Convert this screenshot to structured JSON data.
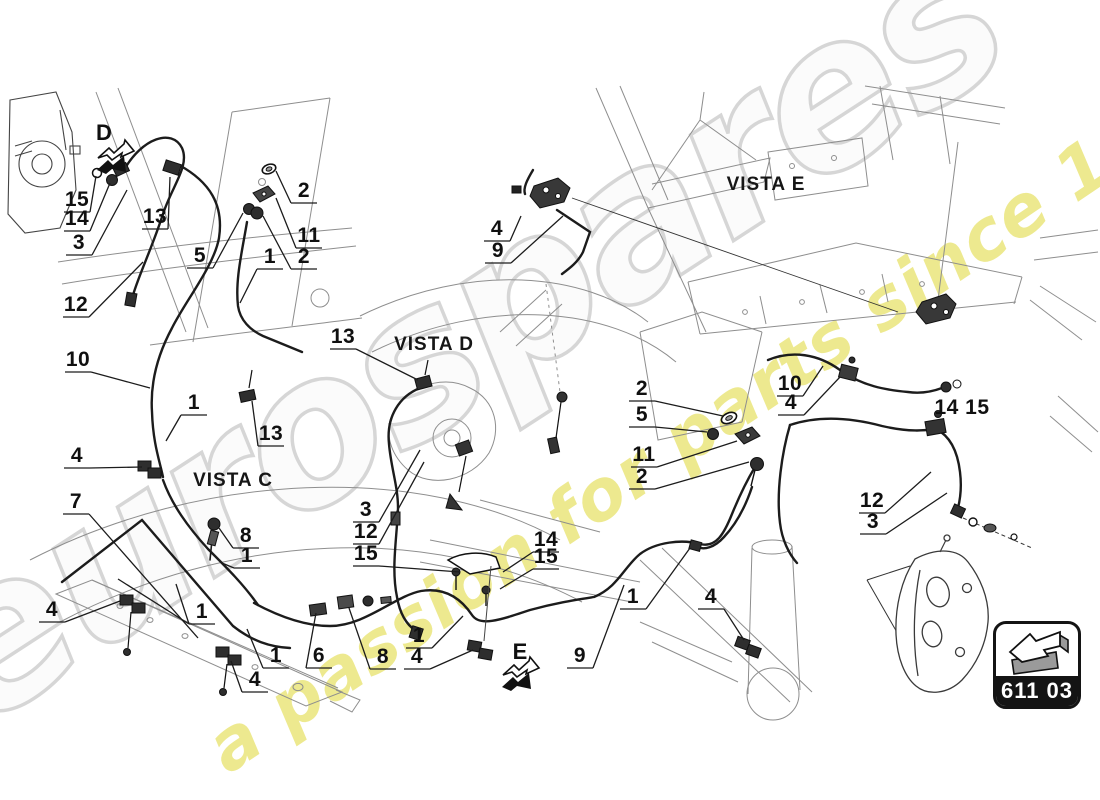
{
  "page": {
    "background": "#ffffff",
    "line_color": "#1c1c1c",
    "chassis_line_color": "#8e8e8e"
  },
  "watermark": {
    "brand": "eurospares",
    "tagline": "a passion for parts since 1985",
    "brand_fill": "#fbfbfb",
    "brand_outline": "#d4d4d4",
    "tagline_color": "#e9e474"
  },
  "badge": {
    "code": "611 03",
    "icon": "3d-arrow-left-icon"
  },
  "views": [
    "VISTA C",
    "VISTA D",
    "VISTA E"
  ],
  "direction_markers": [
    "D",
    "E"
  ],
  "callouts": [
    {
      "t": "15",
      "x": 77,
      "y": 200,
      "tx": 96,
      "ty": 176
    },
    {
      "t": "14",
      "x": 77,
      "y": 219,
      "tx": 110,
      "ty": 183
    },
    {
      "t": "3",
      "x": 79,
      "y": 243,
      "tx": 127,
      "ty": 190
    },
    {
      "t": "13",
      "x": 155,
      "y": 217,
      "tx": 170,
      "ty": 177
    },
    {
      "t": "12",
      "x": 76,
      "y": 305,
      "tx": 143,
      "ty": 262
    },
    {
      "t": "5",
      "x": 200,
      "y": 256,
      "tx": 243,
      "ty": 213
    },
    {
      "t": "1",
      "x": 270,
      "y": 257,
      "tx": 240,
      "ty": 303
    },
    {
      "t": "2",
      "x": 304,
      "y": 191,
      "tx": 276,
      "ty": 171
    },
    {
      "t": "11",
      "x": 309,
      "y": 236,
      "tx": 276,
      "ty": 198
    },
    {
      "t": "2",
      "x": 304,
      "y": 257,
      "tx": 263,
      "ty": 216
    },
    {
      "t": "10",
      "x": 78,
      "y": 360,
      "tx": 150,
      "ty": 388
    },
    {
      "t": "1",
      "x": 194,
      "y": 403,
      "tx": 166,
      "ty": 441
    },
    {
      "t": "13",
      "x": 271,
      "y": 434,
      "tx": 252,
      "ty": 401
    },
    {
      "t": "4",
      "x": 77,
      "y": 456,
      "tx": 142,
      "ty": 467
    },
    {
      "t": "7",
      "x": 76,
      "y": 502,
      "tx": 198,
      "ty": 638
    },
    {
      "t": "8",
      "x": 246,
      "y": 536,
      "tx": 219,
      "ty": 528
    },
    {
      "t": "1",
      "x": 247,
      "y": 556,
      "tx": 222,
      "ty": 563
    },
    {
      "t": "4",
      "x": 52,
      "y": 610,
      "tx": 120,
      "ty": 601
    },
    {
      "t": "1",
      "x": 202,
      "y": 612,
      "tx": 118,
      "ty": 579,
      "tx2": 176,
      "ty2": 584
    },
    {
      "t": "1",
      "x": 276,
      "y": 656,
      "tx": 247,
      "ty": 629
    },
    {
      "t": "6",
      "x": 319,
      "y": 656,
      "tx": 316,
      "ty": 613
    },
    {
      "t": "4",
      "x": 255,
      "y": 680,
      "tx": 231,
      "ty": 661
    },
    {
      "t": "8",
      "x": 383,
      "y": 657,
      "tx": 349,
      "ty": 608
    },
    {
      "t": "1",
      "x": 419,
      "y": 636,
      "tx": 463,
      "ty": 616
    },
    {
      "t": "4",
      "x": 417,
      "y": 657,
      "tx": 473,
      "ty": 650
    },
    {
      "t": "9",
      "x": 580,
      "y": 656,
      "tx": 624,
      "ty": 585
    },
    {
      "t": "1",
      "x": 633,
      "y": 597,
      "tx": 690,
      "ty": 548
    },
    {
      "t": "4",
      "x": 711,
      "y": 597,
      "tx": 744,
      "ty": 640
    },
    {
      "t": "13",
      "x": 343,
      "y": 337,
      "tx": 418,
      "ty": 380
    },
    {
      "t": "3",
      "x": 366,
      "y": 510,
      "tx": 420,
      "ty": 450
    },
    {
      "t": "12",
      "x": 366,
      "y": 532,
      "tx": 424,
      "ty": 462
    },
    {
      "t": "15",
      "x": 366,
      "y": 554,
      "tx": 460,
      "ty": 572
    },
    {
      "t": "14",
      "x": 546,
      "y": 540,
      "tx": 503,
      "ty": 572
    },
    {
      "t": "15",
      "x": 546,
      "y": 557,
      "tx": 500,
      "ty": 589
    },
    {
      "t": "4",
      "x": 497,
      "y": 229,
      "tx": 521,
      "ty": 216
    },
    {
      "t": "9",
      "x": 498,
      "y": 251,
      "tx": 563,
      "ty": 216
    },
    {
      "t": "2",
      "x": 642,
      "y": 389,
      "tx": 723,
      "ty": 416
    },
    {
      "t": "5",
      "x": 642,
      "y": 415,
      "tx": 707,
      "ty": 432
    },
    {
      "t": "11",
      "x": 644,
      "y": 455,
      "tx": 737,
      "ty": 441
    },
    {
      "t": "2",
      "x": 642,
      "y": 477,
      "tx": 749,
      "ty": 462
    },
    {
      "t": "10",
      "x": 790,
      "y": 384,
      "tx": 823,
      "ty": 366
    },
    {
      "t": "4",
      "x": 791,
      "y": 403,
      "tx": 840,
      "ty": 377
    },
    {
      "t": "14 15",
      "x": 962,
      "y": 408
    },
    {
      "t": "12",
      "x": 872,
      "y": 501,
      "tx": 931,
      "ty": 472
    },
    {
      "t": "3",
      "x": 873,
      "y": 522,
      "tx": 947,
      "ty": 493
    }
  ],
  "view_labels": [
    {
      "t": "VISTA C",
      "x": 233,
      "y": 481
    },
    {
      "t": "VISTA D",
      "x": 434,
      "y": 345
    },
    {
      "t": "VISTA E",
      "x": 766,
      "y": 185
    }
  ],
  "dir_labels": [
    {
      "t": "D",
      "x": 104,
      "y": 133
    },
    {
      "t": "E",
      "x": 520,
      "y": 652
    }
  ]
}
